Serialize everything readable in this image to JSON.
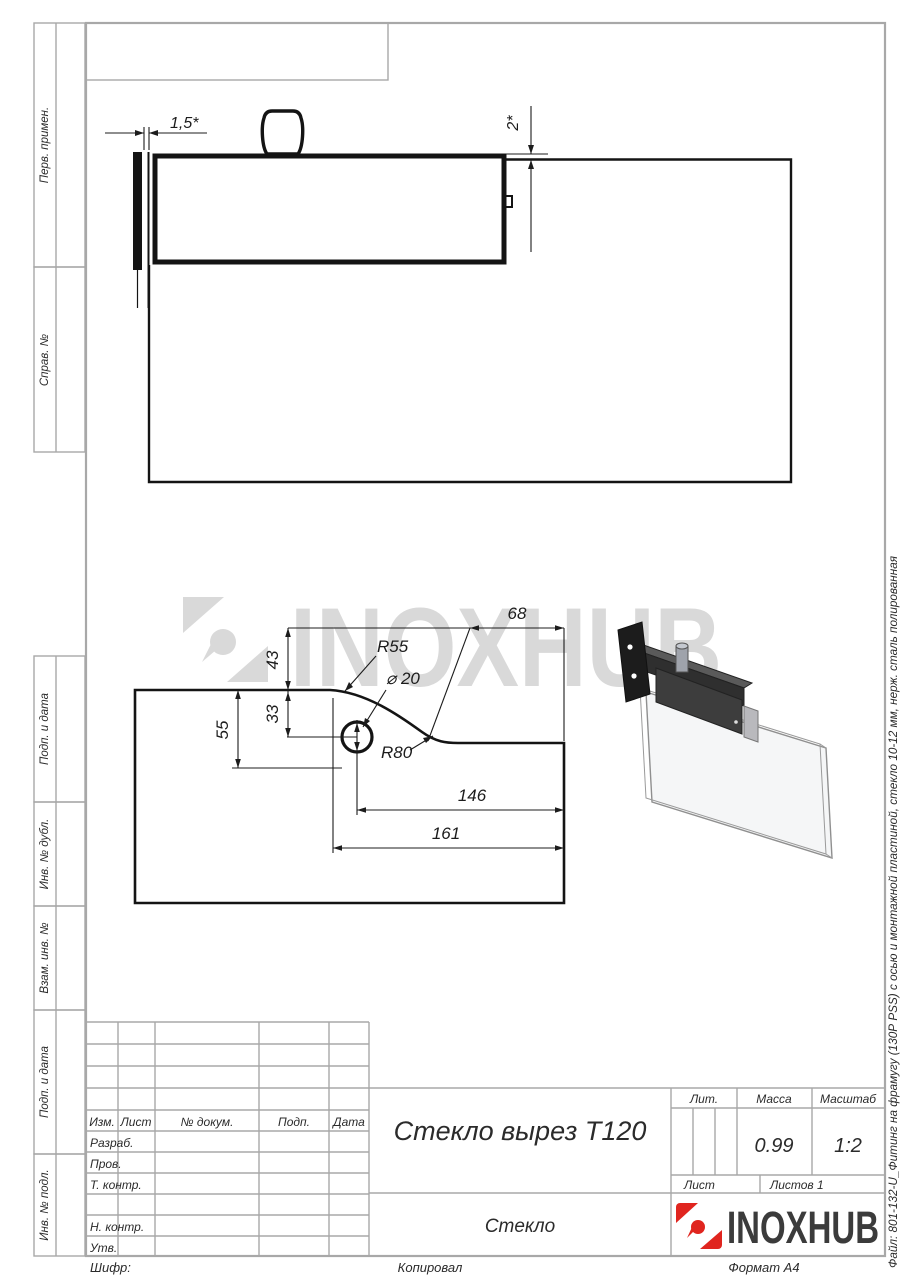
{
  "colors": {
    "line_gray": "#a8a8a8",
    "drawing_black": "#141414",
    "logo_red": "#e0251f",
    "watermark_gray": "#d9d9d9"
  },
  "left_margin": {
    "labels": [
      "Перв. примен.",
      "Справ. №",
      "Подп. и дата",
      "Инв. № дубл.",
      "Взам. инв. №",
      "Подп. и дата",
      "Инв. № подл."
    ]
  },
  "revision_table": {
    "cols": [
      "Изм.",
      "Лист",
      "№ докум.",
      "Подп.",
      "Дата"
    ]
  },
  "title_block": {
    "title": "Стекло вырез Т120",
    "sign_rows": [
      "Разраб.",
      "Пров.",
      "Т. контр.",
      "Н. контр.",
      "Утв."
    ],
    "lit_label": "Лит.",
    "mass_label": "Масса",
    "mass_value": "0.99",
    "scale_label": "Масштаб",
    "scale_value": "1:2",
    "sheet_label": "Лист",
    "sheets_label": "Листов 1",
    "material": "Стекло",
    "brand": "INOXHUB"
  },
  "watermark": {
    "text": "INOXHUB"
  },
  "side_note": "Файл: 801-132-U_Фитинг на фрамугу (130Р PSS) с осью и монтажной пластиной, стекло 10-12 мм, нерж. сталь полированная",
  "footer": {
    "code": "Шифр:",
    "copied": "Копировал",
    "format": "Формат А4"
  },
  "drawing": {
    "top_view": {
      "gap": "1,5*",
      "offset": "2*"
    },
    "cutout": {
      "w68": "68",
      "h43": "43",
      "r55": "R55",
      "dia": "⌀ 20",
      "h55": "55",
      "h33": "33",
      "r80": "R80",
      "l146": "146",
      "l161": "161"
    }
  }
}
